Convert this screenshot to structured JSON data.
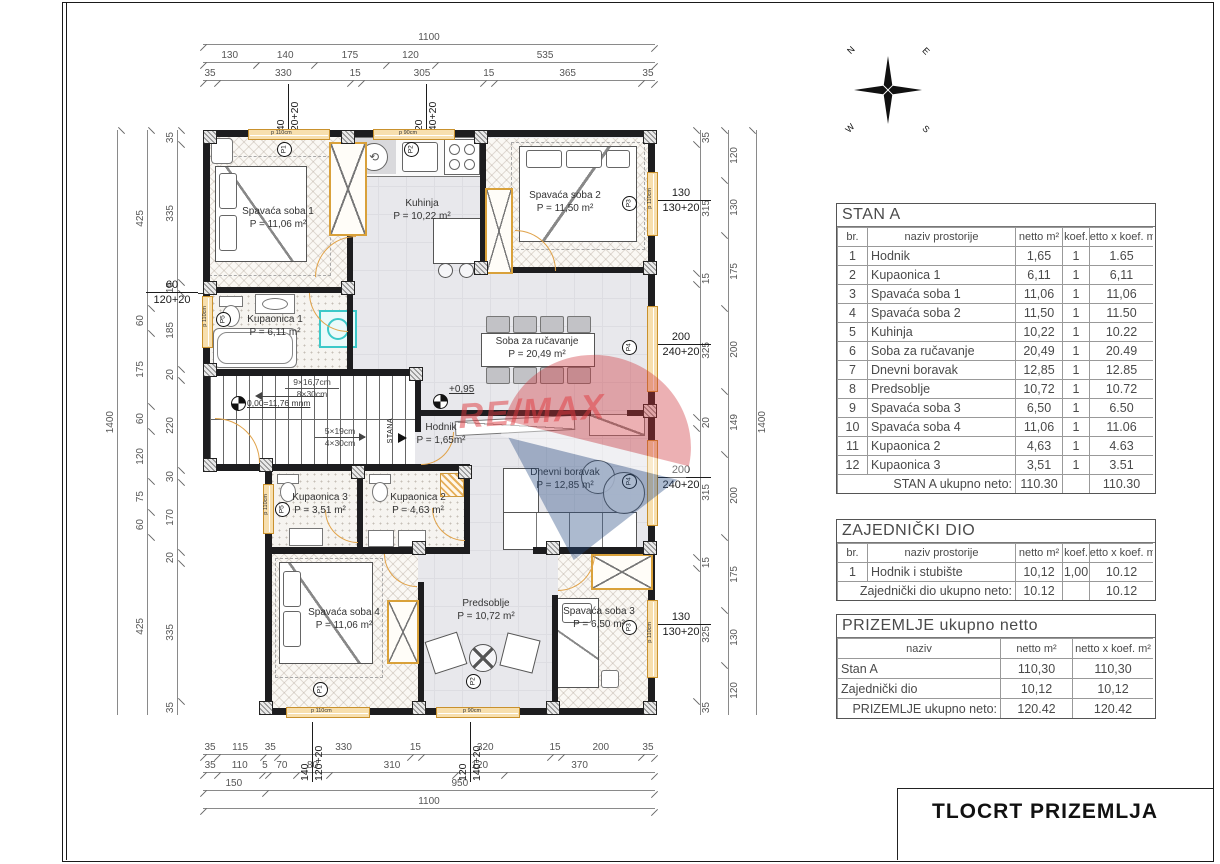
{
  "page": {
    "title": "TLOCRT PRIZEMLJA"
  },
  "compass": {
    "n": "N",
    "e": "E",
    "w": "W",
    "s": "S"
  },
  "watermark": {
    "brand": "RE/MAX"
  },
  "plan": {
    "rooms": {
      "spavaca1": {
        "name": "Spavaća soba 1",
        "area": "P = 11,06 m²"
      },
      "kuhinja": {
        "name": "Kuhinja",
        "area": "P = 10,22 m²"
      },
      "spavaca2": {
        "name": "Spavaća soba 2",
        "area": "P = 11,50 m²"
      },
      "kupaonica1": {
        "name": "Kupaonica 1",
        "area": "P = 6,11 m²"
      },
      "soba_za_rucavanje": {
        "name": "Soba za ručavanje",
        "area": "P = 20,49 m²"
      },
      "hodnik": {
        "name": "Hodnik",
        "area": "P = 1,65m²"
      },
      "dnevni_boravak": {
        "name": "Dnevni boravak",
        "area": "P = 12,85 m²"
      },
      "kupaonica3": {
        "name": "Kupaonica 3",
        "area": "P = 3,51 m²"
      },
      "kupaonica2": {
        "name": "Kupaonica 2",
        "area": "P = 4,63 m²"
      },
      "spavaca4": {
        "name": "Spavaća soba 4",
        "area": "P = 11,06 m²"
      },
      "predsoblje": {
        "name": "Predsoblje",
        "area": "P = 10,72 m²"
      },
      "spavaca3": {
        "name": "Spavaća soba 3",
        "area": "P = 6,50 m²"
      }
    },
    "stairs": {
      "flight_up": "9×16,7cm",
      "tread_up": "8×30cm",
      "flight_down": "5×19cm",
      "tread_down": "4×30cm",
      "level_zero": "0,00=11,76 mnm"
    },
    "entrance_label": "STANA",
    "level_mark": "+0,95",
    "windows": {
      "top1": {
        "w": "140",
        "h": "120+20",
        "parapet": "p 110cm",
        "mark": "P1"
      },
      "top2": {
        "w": "120",
        "h": "140+20",
        "parapet": "p 90cm",
        "mark": "P2"
      },
      "left1": {
        "w": "60",
        "h": "120+20",
        "parapet": "p 110cm",
        "mark": "P5"
      },
      "left2": {
        "w": "60",
        "h": "120+20",
        "parapet": "p 110cm",
        "mark": "P5"
      },
      "right1": {
        "w": "130",
        "h": "130+20",
        "parapet": "p 110cm",
        "mark": "P3"
      },
      "right2": {
        "w": "200",
        "h": "240+20",
        "parapet": "",
        "mark": "P4"
      },
      "right3": {
        "w": "200",
        "h": "240+20",
        "parapet": "",
        "mark": "P4"
      },
      "right4": {
        "w": "130",
        "h": "130+20",
        "parapet": "p 110cm",
        "mark": "P3"
      },
      "bottom1": {
        "w": "140",
        "h": "120+20",
        "parapet": "p 110cm",
        "mark": "P1"
      },
      "bottom2": {
        "w": "120",
        "h": "140+20",
        "parapet": "p 90cm",
        "mark": "P2"
      }
    }
  },
  "dimensions": {
    "top": {
      "row1": [
        "1100"
      ],
      "row2": [
        "130",
        "140",
        "175",
        "120",
        "535"
      ],
      "row3": [
        "35",
        "330",
        "15",
        "305",
        "15",
        "365",
        "35"
      ]
    },
    "bottom": {
      "row1": [
        "35",
        "115",
        "35",
        "330",
        "15",
        "320",
        "15",
        "200",
        "35"
      ],
      "row2": [
        "35",
        "110",
        "5",
        "70",
        "80",
        "310",
        "120",
        "370"
      ],
      "row3": [
        "150",
        "950"
      ],
      "row4": [
        "1100"
      ]
    },
    "left": {
      "outer": [
        "1400"
      ],
      "mid": [
        "425",
        "60",
        "175",
        "60",
        "120",
        "75",
        "60",
        "425"
      ],
      "inner": [
        "35",
        "335",
        "15",
        "185",
        "20",
        "220",
        "30",
        "170",
        "20",
        "335",
        "35"
      ]
    },
    "right": {
      "inner": [
        "35",
        "315",
        "15",
        "325",
        "20",
        "315",
        "15",
        "325",
        "35"
      ],
      "mid": [
        "120",
        "130",
        "175",
        "200",
        "149",
        "200",
        "175",
        "130",
        "120"
      ],
      "outer": [
        "1400"
      ]
    }
  },
  "tables": {
    "stan_a": {
      "title": "STAN A",
      "headers": [
        "br.",
        "naziv prostorije",
        "netto m²",
        "koef.",
        "netto x koef. m²"
      ],
      "rows": [
        [
          "1",
          "Hodnik",
          "1,65",
          "1",
          "1.65"
        ],
        [
          "2",
          "Kupaonica 1",
          "6,11",
          "1",
          "6,11"
        ],
        [
          "3",
          "Spavaća soba 1",
          "11,06",
          "1",
          "11,06"
        ],
        [
          "4",
          "Spavaća soba 2",
          "11,50",
          "1",
          "11.50"
        ],
        [
          "5",
          "Kuhinja",
          "10,22",
          "1",
          "10.22"
        ],
        [
          "6",
          "Soba za ručavanje",
          "20,49",
          "1",
          "20.49"
        ],
        [
          "7",
          "Dnevni boravak",
          "12,85",
          "1",
          "12.85"
        ],
        [
          "8",
          "Predsoblje",
          "10,72",
          "1",
          "10.72"
        ],
        [
          "9",
          "Spavaća soba 3",
          "6,50",
          "1",
          "6.50"
        ],
        [
          "10",
          "Spavaća soba 4",
          "11,06",
          "1",
          "11.06"
        ],
        [
          "11",
          "Kupaonica 2",
          "4,63",
          "1",
          "4.63"
        ],
        [
          "12",
          "Kupaonica 3",
          "3,51",
          "1",
          "3.51"
        ]
      ],
      "footer": [
        "STAN A ukupno neto:",
        "110.30",
        "",
        "110.30"
      ]
    },
    "zajednicki": {
      "title": "ZAJEDNIČKI DIO",
      "headers": [
        "br.",
        "naziv prostorije",
        "netto m²",
        "koef.",
        "netto x koef. m²"
      ],
      "rows": [
        [
          "1",
          "Hodnik i stubište",
          "10,12",
          "1,00",
          "10.12"
        ]
      ],
      "footer": [
        "Zajednički dio ukupno neto:",
        "10.12",
        "",
        "10.12"
      ]
    },
    "prizemlje": {
      "title": "PRIZEMLJE ukupno netto",
      "headers": [
        "naziv",
        "netto m²",
        "netto x koef. m²"
      ],
      "rows": [
        [
          "Stan A",
          "110,30",
          "110,30"
        ],
        [
          "Zajednički dio",
          "10,12",
          "10,12"
        ]
      ],
      "footer": [
        "PRIZEMLJE ukupno neto:",
        "120.42",
        "120.42"
      ]
    }
  }
}
